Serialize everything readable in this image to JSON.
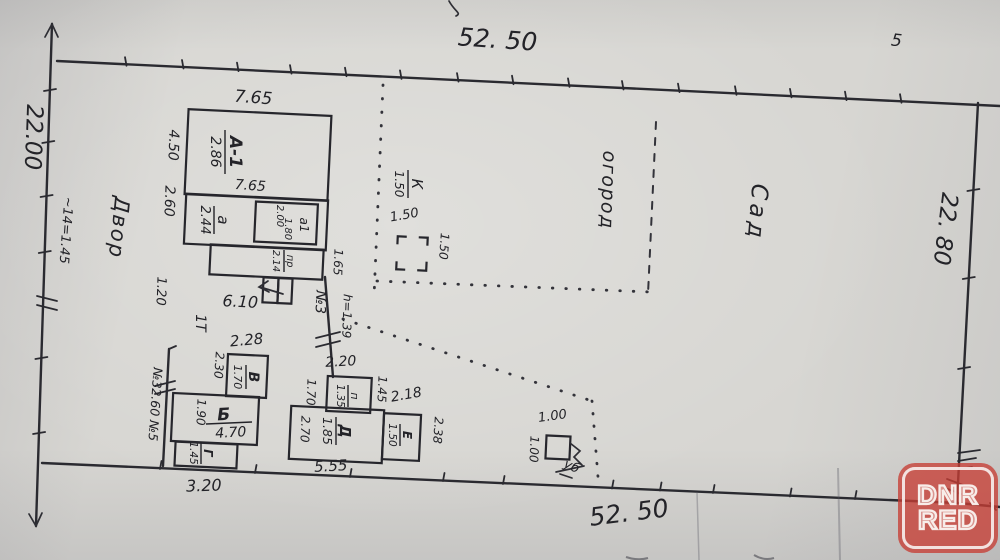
{
  "watermark": {
    "line1": "DNR",
    "line2": "RED"
  },
  "boundary": {
    "top": "52. 50",
    "bottom": "52. 50",
    "left": "22.00",
    "right": "22. 80",
    "left_fence_note": "~14=1.45",
    "stray_mark": "5"
  },
  "areas": {
    "yard": "Двор",
    "garden": "огород",
    "orchard": "Сад"
  },
  "house": {
    "label": "А-1",
    "area": "2.86",
    "width_top": "7.65",
    "width_inner": "7.65",
    "height_main": "4.50",
    "height_annex": "2.60",
    "annex_label": "а",
    "annex_area": "2.44",
    "room_label": "а1",
    "room_w": "2.00",
    "room_h": "1.80",
    "porch_label": "пр",
    "porch_area": "2.14",
    "porch_side": "1.20",
    "base_width": "6.10",
    "gap_right": "1.65"
  },
  "fence3": {
    "label": "№3",
    "height": "h=1.39",
    "gate": "1Т",
    "side_note": "№32.60 №5"
  },
  "sheds": {
    "v": {
      "label": "В",
      "area": "1.70",
      "top": "2.28",
      "left": "2.30"
    },
    "b": {
      "label": "Б",
      "area": "4.70",
      "left": "1.90",
      "bottom": "3.20"
    },
    "g": {
      "label": "Г",
      "area": "1.45"
    },
    "p": {
      "label": "п",
      "area": "1.35",
      "top": "2.20",
      "left": "1.70",
      "right": "1.45",
      "gap": "2.18"
    },
    "d": {
      "label": "Д",
      "area": "1.85",
      "left": "2.70",
      "bottom": "5.55"
    },
    "e": {
      "label": "Е",
      "area": "1.50",
      "right": "2.38"
    },
    "k": {
      "label": "К",
      "area": "1.50",
      "w": "1.50",
      "h": "1.50"
    },
    "out": {
      "label": "уб",
      "top": "1.00",
      "left": "1.00"
    }
  }
}
